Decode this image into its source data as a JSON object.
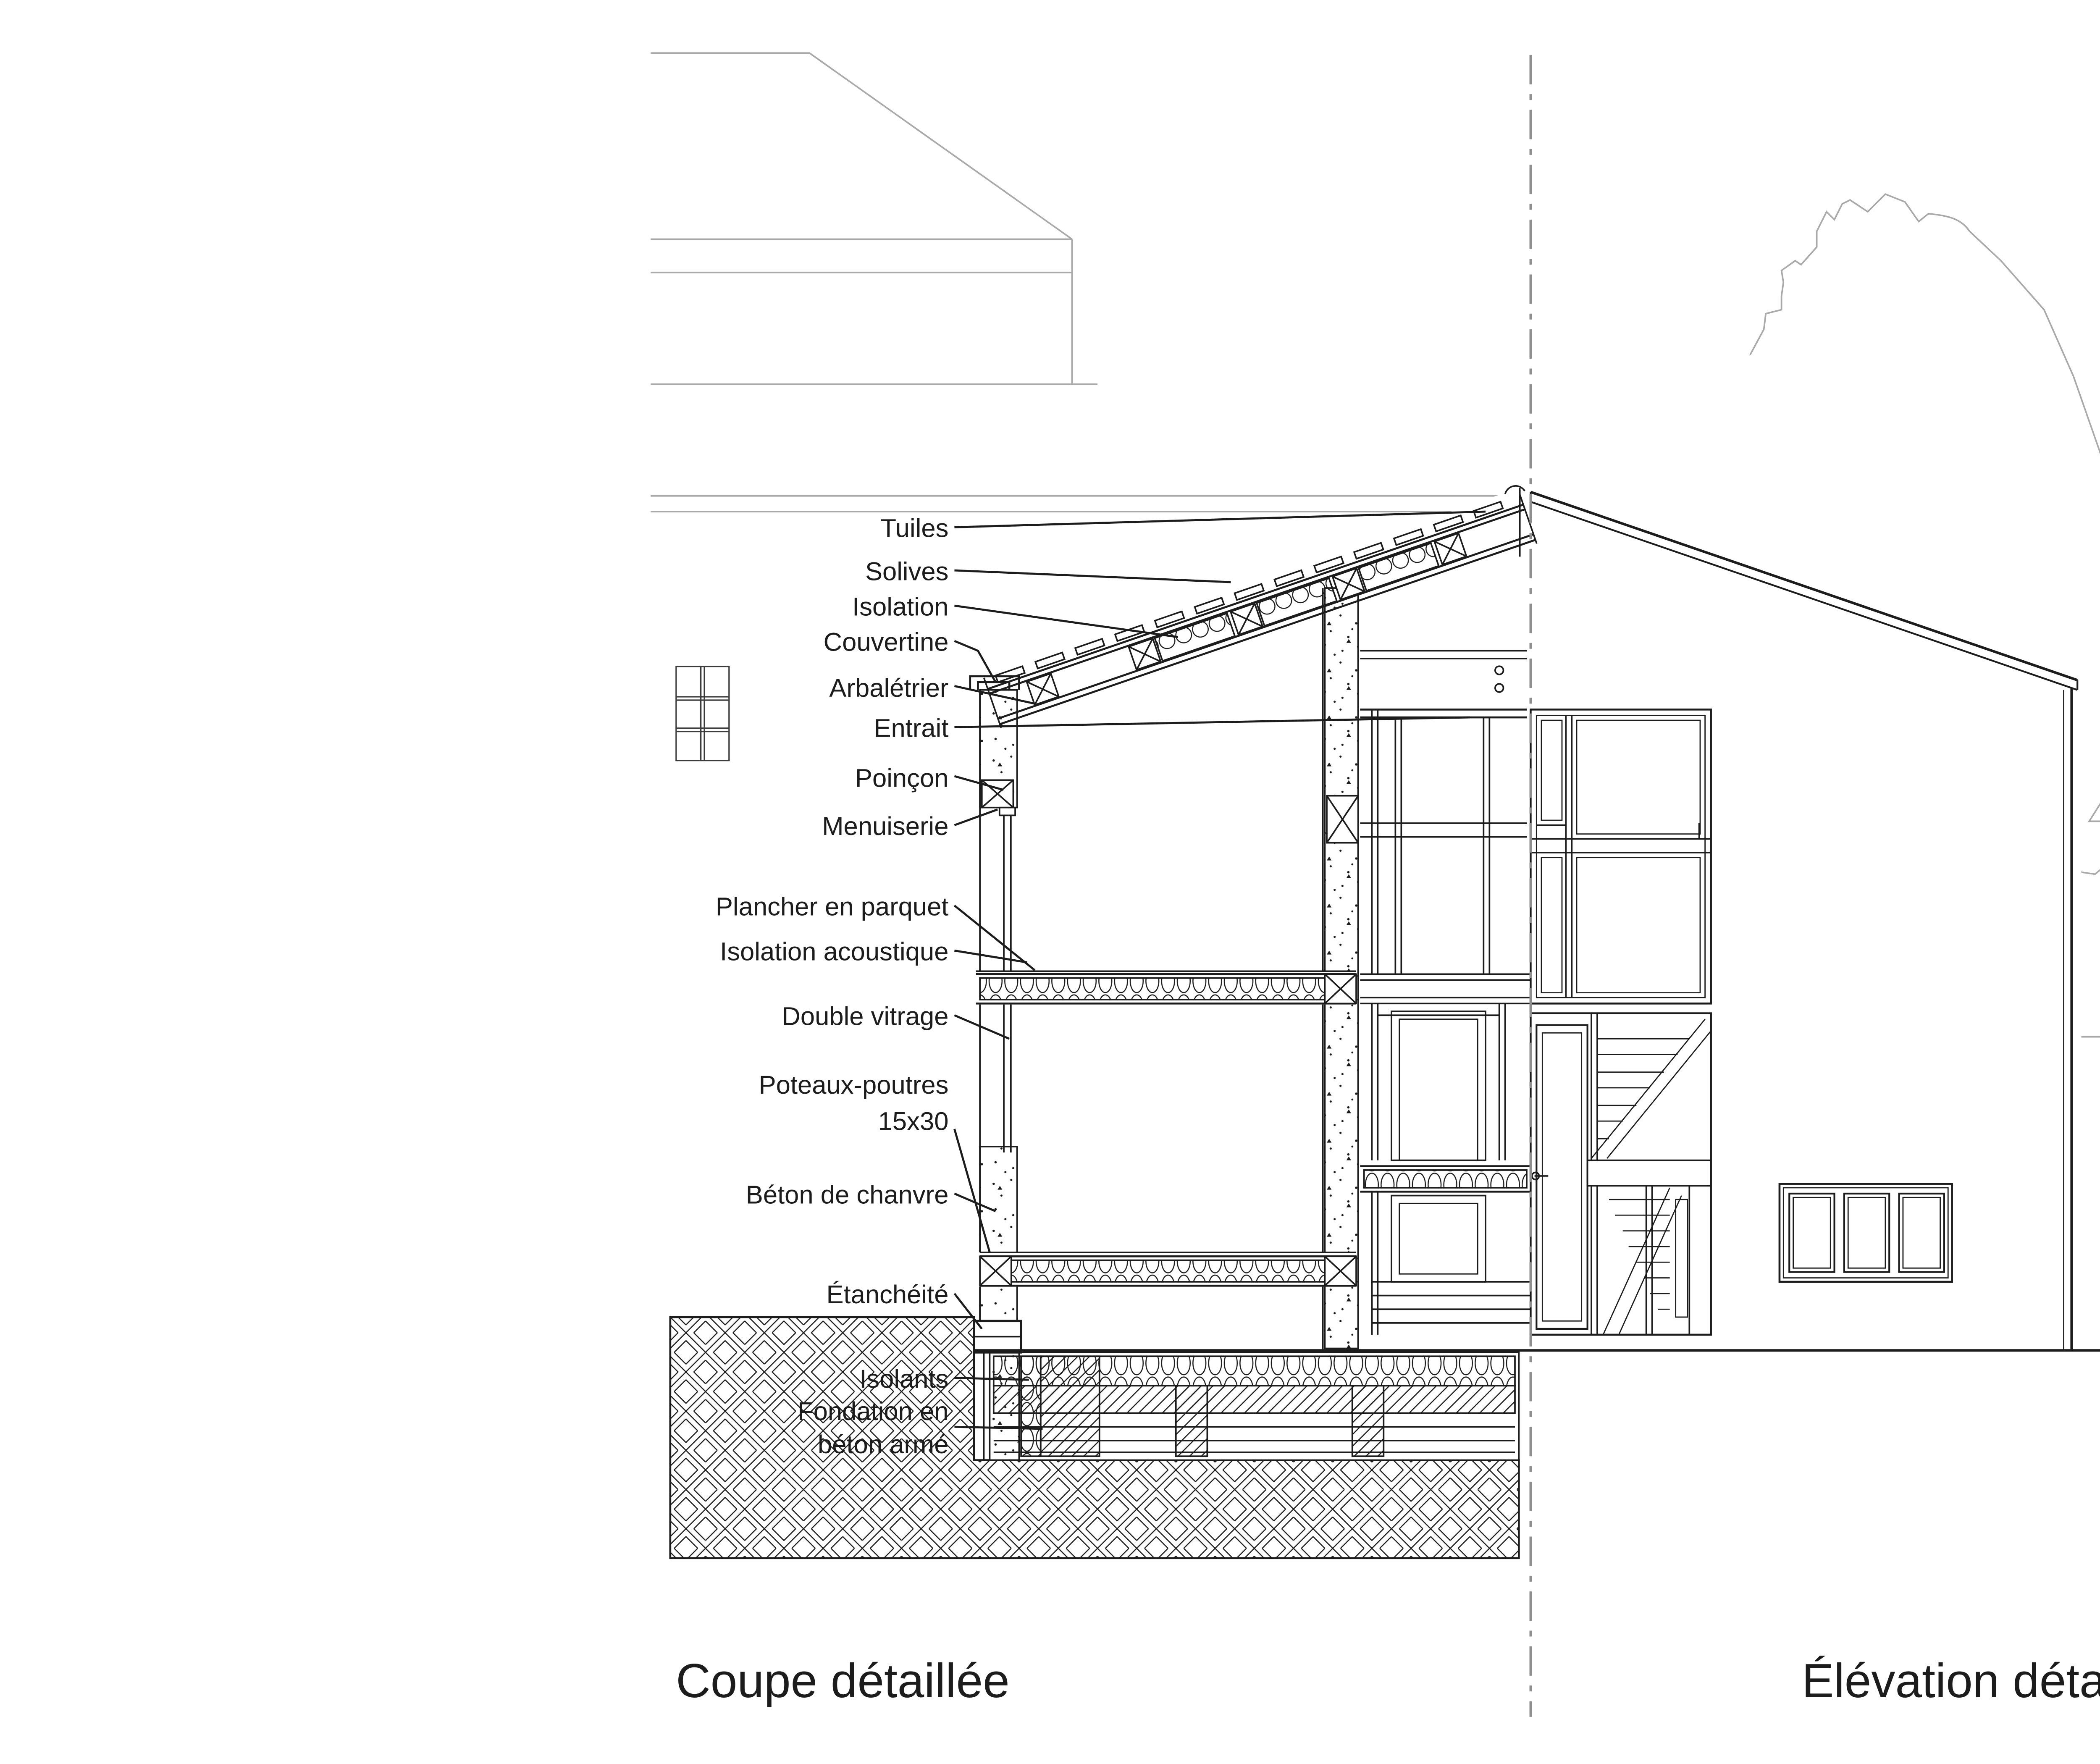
{
  "drawing": {
    "type": "architectural-section-and-elevation",
    "section_title": "Coupe détaillée",
    "elevation_title": "Élévation détaillée façade",
    "ink_color": "#1c1c1c",
    "background_line_color": "#a9a9a9",
    "section_cut_line_color": "#8f8f8f",
    "paper_color": "#ffffff",
    "annotations": [
      {
        "label": "Tuiles"
      },
      {
        "label": "Solives"
      },
      {
        "label": "Isolation"
      },
      {
        "label": "Couvertine"
      },
      {
        "label": "Arbalétrier"
      },
      {
        "label": "Entrait"
      },
      {
        "label": "Poinçon"
      },
      {
        "label": "Menuiserie"
      },
      {
        "label": "Plancher en parquet"
      },
      {
        "label": "Isolation acoustique"
      },
      {
        "label": "Double vitrage"
      },
      {
        "label": "Poteaux-poutres",
        "label_line2": "15x30"
      },
      {
        "label": "Béton de chanvre"
      },
      {
        "label": "Étanchéité"
      },
      {
        "label": "Isolants"
      },
      {
        "label": "Fondation en",
        "label_line2": "béton armé"
      }
    ]
  }
}
